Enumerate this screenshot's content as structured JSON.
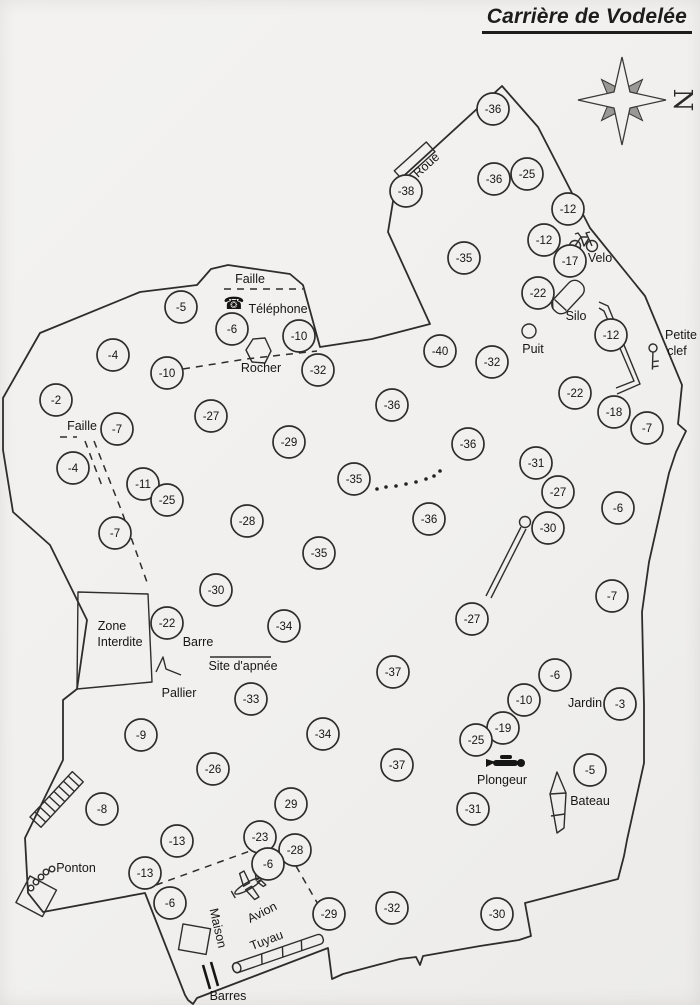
{
  "title": "Carrière de Vodelée",
  "compass_letter": "N",
  "icons": {
    "telephone_glyph": "☎"
  },
  "colors": {
    "ink": "#2e2d2b",
    "paper": "#f1f0ee"
  },
  "depth_markers": [
    {
      "x": 493,
      "y": 109,
      "v": "-36"
    },
    {
      "x": 527,
      "y": 174,
      "v": "-25"
    },
    {
      "x": 494,
      "y": 179,
      "v": "-36"
    },
    {
      "x": 406,
      "y": 191,
      "v": "-38"
    },
    {
      "x": 568,
      "y": 209,
      "v": "-12"
    },
    {
      "x": 544,
      "y": 240,
      "v": "-12"
    },
    {
      "x": 464,
      "y": 258,
      "v": "-35"
    },
    {
      "x": 570,
      "y": 261,
      "v": "-17"
    },
    {
      "x": 538,
      "y": 293,
      "v": "-22"
    },
    {
      "x": 181,
      "y": 307,
      "v": "-5"
    },
    {
      "x": 232,
      "y": 329,
      "v": "-6"
    },
    {
      "x": 611,
      "y": 335,
      "v": "-12"
    },
    {
      "x": 299,
      "y": 336,
      "v": "-10"
    },
    {
      "x": 440,
      "y": 351,
      "v": "-40"
    },
    {
      "x": 113,
      "y": 355,
      "v": "-4"
    },
    {
      "x": 492,
      "y": 362,
      "v": "-32"
    },
    {
      "x": 318,
      "y": 370,
      "v": "-32"
    },
    {
      "x": 167,
      "y": 373,
      "v": "-10"
    },
    {
      "x": 575,
      "y": 393,
      "v": "-22"
    },
    {
      "x": 56,
      "y": 400,
      "v": "-2"
    },
    {
      "x": 392,
      "y": 405,
      "v": "-36"
    },
    {
      "x": 614,
      "y": 412,
      "v": "-18"
    },
    {
      "x": 211,
      "y": 416,
      "v": "-27"
    },
    {
      "x": 647,
      "y": 428,
      "v": "-7"
    },
    {
      "x": 117,
      "y": 429,
      "v": "-7"
    },
    {
      "x": 289,
      "y": 442,
      "v": "-29"
    },
    {
      "x": 468,
      "y": 444,
      "v": "-36"
    },
    {
      "x": 536,
      "y": 463,
      "v": "-31"
    },
    {
      "x": 73,
      "y": 468,
      "v": "-4"
    },
    {
      "x": 354,
      "y": 479,
      "v": "-35"
    },
    {
      "x": 143,
      "y": 484,
      "v": "-11"
    },
    {
      "x": 558,
      "y": 492,
      "v": "-27"
    },
    {
      "x": 167,
      "y": 500,
      "v": "-25"
    },
    {
      "x": 618,
      "y": 508,
      "v": "-6"
    },
    {
      "x": 429,
      "y": 519,
      "v": "-36"
    },
    {
      "x": 247,
      "y": 521,
      "v": "-28"
    },
    {
      "x": 548,
      "y": 528,
      "v": "-30"
    },
    {
      "x": 115,
      "y": 533,
      "v": "-7"
    },
    {
      "x": 319,
      "y": 553,
      "v": "-35"
    },
    {
      "x": 216,
      "y": 590,
      "v": "-30"
    },
    {
      "x": 612,
      "y": 596,
      "v": "-7"
    },
    {
      "x": 472,
      "y": 619,
      "v": "-27"
    },
    {
      "x": 167,
      "y": 623,
      "v": "-22"
    },
    {
      "x": 284,
      "y": 626,
      "v": "-34"
    },
    {
      "x": 393,
      "y": 672,
      "v": "-37"
    },
    {
      "x": 555,
      "y": 675,
      "v": "-6"
    },
    {
      "x": 251,
      "y": 699,
      "v": "-33"
    },
    {
      "x": 524,
      "y": 700,
      "v": "-10"
    },
    {
      "x": 620,
      "y": 704,
      "v": "-3"
    },
    {
      "x": 503,
      "y": 728,
      "v": "-19"
    },
    {
      "x": 323,
      "y": 734,
      "v": "-34"
    },
    {
      "x": 141,
      "y": 735,
      "v": "-9"
    },
    {
      "x": 476,
      "y": 740,
      "v": "-25"
    },
    {
      "x": 397,
      "y": 765,
      "v": "-37"
    },
    {
      "x": 213,
      "y": 769,
      "v": "-26"
    },
    {
      "x": 590,
      "y": 770,
      "v": "-5"
    },
    {
      "x": 291,
      "y": 804,
      "v": "29"
    },
    {
      "x": 102,
      "y": 809,
      "v": "-8"
    },
    {
      "x": 473,
      "y": 809,
      "v": "-31"
    },
    {
      "x": 260,
      "y": 837,
      "v": "-23"
    },
    {
      "x": 177,
      "y": 841,
      "v": "-13"
    },
    {
      "x": 295,
      "y": 850,
      "v": "-28"
    },
    {
      "x": 268,
      "y": 864,
      "v": "-6"
    },
    {
      "x": 145,
      "y": 873,
      "v": "-13"
    },
    {
      "x": 170,
      "y": 903,
      "v": "-6"
    },
    {
      "x": 392,
      "y": 908,
      "v": "-32"
    },
    {
      "x": 329,
      "y": 914,
      "v": "-29"
    },
    {
      "x": 497,
      "y": 914,
      "v": "-30"
    }
  ],
  "place_labels": [
    {
      "x": 250,
      "y": 283,
      "text": "Faille"
    },
    {
      "x": 278,
      "y": 313,
      "text": "Téléphone"
    },
    {
      "x": 261,
      "y": 372,
      "text": "Rocher"
    },
    {
      "x": 82,
      "y": 430,
      "text": "Faille"
    },
    {
      "x": 429,
      "y": 168,
      "text": "Roue",
      "rot": -42
    },
    {
      "x": 600,
      "y": 262,
      "text": "Velo"
    },
    {
      "x": 576,
      "y": 320,
      "text": "Silo"
    },
    {
      "x": 533,
      "y": 353,
      "text": "Puit"
    },
    {
      "x": 681,
      "y": 339,
      "text": "Petite"
    },
    {
      "x": 677,
      "y": 355,
      "text": "clef"
    },
    {
      "x": 112,
      "y": 630,
      "text": "Zone"
    },
    {
      "x": 120,
      "y": 646,
      "text": "Interdite"
    },
    {
      "x": 198,
      "y": 646,
      "text": "Barre"
    },
    {
      "x": 243,
      "y": 670,
      "text": "Site d'apnée"
    },
    {
      "x": 179,
      "y": 697,
      "text": "Pallier"
    },
    {
      "x": 585,
      "y": 707,
      "text": "Jardin"
    },
    {
      "x": 502,
      "y": 784,
      "text": "Plongeur"
    },
    {
      "x": 590,
      "y": 805,
      "text": "Bateau"
    },
    {
      "x": 76,
      "y": 872,
      "text": "Ponton"
    },
    {
      "x": 214,
      "y": 929,
      "text": "Maison",
      "rot": 77
    },
    {
      "x": 264,
      "y": 916,
      "text": "Avion",
      "rot": -27
    },
    {
      "x": 268,
      "y": 944,
      "text": "Tuyau",
      "rot": -21
    },
    {
      "x": 228,
      "y": 1000,
      "text": "Barres"
    }
  ]
}
